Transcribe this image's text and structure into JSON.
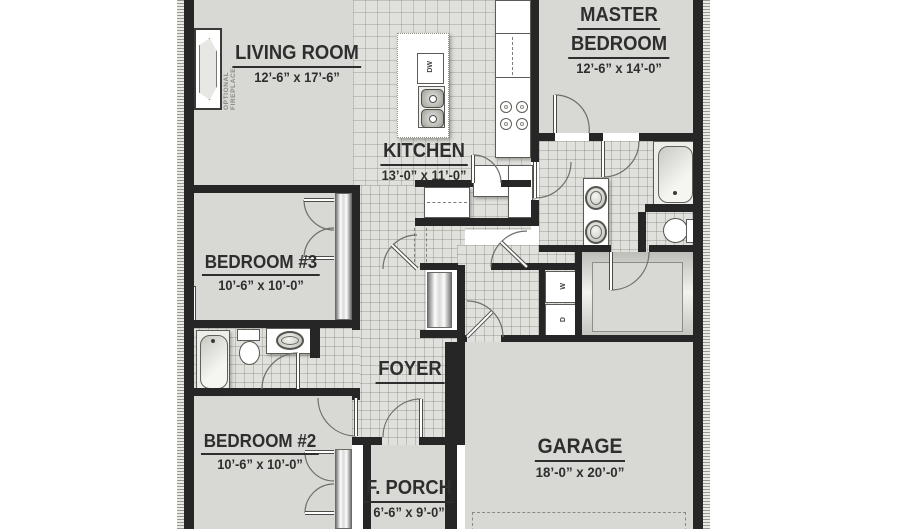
{
  "rooms": {
    "living_room": {
      "name": "LIVING ROOM",
      "dims": "12’-6” x 17’-6”"
    },
    "kitchen": {
      "name": "KITCHEN",
      "dims": "13’-0” x 11’-0”"
    },
    "master_bedroom": {
      "name_line1": "MASTER",
      "name_line2": "BEDROOM",
      "dims": "12’-6” x 14’-0”"
    },
    "bedroom_3": {
      "name": "BEDROOM #3",
      "dims": "10’-6” x 10’-0”"
    },
    "bedroom_2": {
      "name": "BEDROOM #2",
      "dims": "10’-6” x 10’-0”"
    },
    "foyer": {
      "name": "FOYER"
    },
    "garage": {
      "name": "GARAGE",
      "dims": "18’-0” x 20’-0”"
    },
    "front_porch": {
      "name": "F. PORCH",
      "dims": "6’-6” x 9’-0”"
    }
  },
  "labels": {
    "optional_fireplace": "OPTIONAL FIREPLACE",
    "dishwasher": "DW",
    "washer": "W",
    "dryer": "D"
  },
  "colors": {
    "wall": "#262626",
    "floor": "#d8d8d4",
    "tile_floor": "#e0e0dc",
    "background": "#ffffff"
  }
}
